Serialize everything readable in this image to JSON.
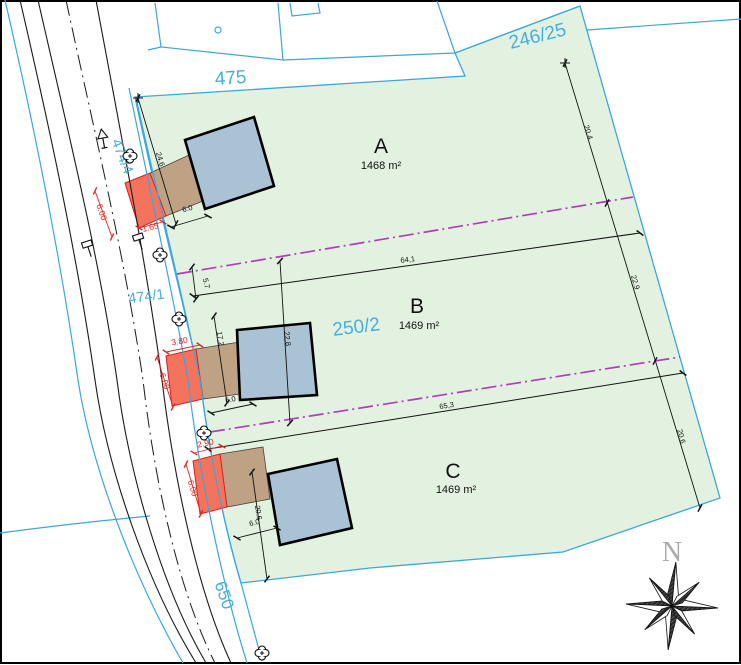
{
  "plan": {
    "title_parcels": [
      {
        "label": "A",
        "area": "1468 m²"
      },
      {
        "label": "B",
        "area": "1469 m²"
      },
      {
        "label": "C",
        "area": "1469 m²"
      }
    ],
    "cadastral_labels": {
      "c475": "475",
      "c246_25": "246/25",
      "c474_4": "474/4",
      "c474_1": "474/1",
      "c250_2": "250/2",
      "c650": "650"
    },
    "dimensions_black": {
      "d24_6": "24.6",
      "d6_0a": "6.0",
      "d5_7": "5.7",
      "d64_1": "64,1",
      "d17_2": "17.2",
      "d22_8": "22.8",
      "d6_0b": "6.0",
      "d65_3": "65,3",
      "d20_6c": "20.6",
      "d6_0c": "6.0",
      "d20_4": "20.4",
      "d22_9": "22.9",
      "d20_6r": "20.6"
    },
    "dimensions_red": {
      "r6_00a": "6.00",
      "r1_65": "1.65",
      "r3_80": "3.80",
      "r6_00b": "6.00",
      "r2_90": "2.90",
      "r6_00c": "6.00"
    },
    "compass": {
      "north_label": "N"
    },
    "symbols": [
      "lamp-rosette",
      "traffic-sign",
      "tree-triangle-sign",
      "boundary-circle",
      "compass-rose"
    ],
    "colors": {
      "parcel_green": "#e3f2e0",
      "parcel_border_cyan": "#3aa7dd",
      "building_fill": "#a9c3d5",
      "driveway_red": "#f4735c",
      "driveway_tan": "#bfa183",
      "dimension_red": "#e42420",
      "building_limit_purple": "#b33bbd",
      "road_black": "#1a1a1a",
      "north_gray": "#aaaaaa"
    }
  }
}
